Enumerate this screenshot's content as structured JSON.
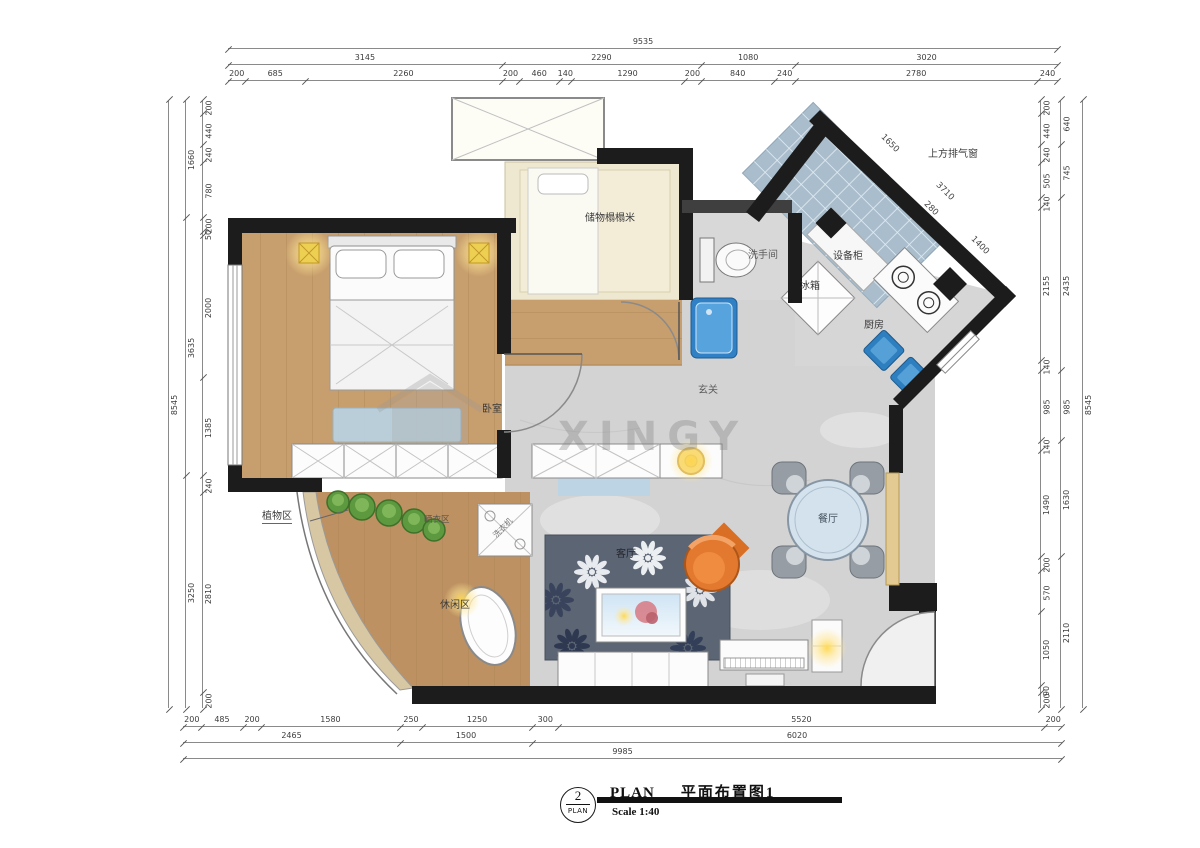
{
  "title_block": {
    "number": "2",
    "number_sub": "PLAN",
    "name_en": "PLAN",
    "name_zh": "平面布置图1",
    "scale": "Scale 1:40"
  },
  "watermark": {
    "text": "XINGY"
  },
  "rooms": {
    "bedroom": "卧室",
    "tatami_storage": "储物榻榻米",
    "bathroom": "洗手间",
    "kitchen": "厨房",
    "fridge": "冰箱",
    "equipment_cabinet": "设备柜",
    "entry": "玄关",
    "dining": "餐厅",
    "living": "客厅",
    "plant_area": "植物区",
    "laundry_area": "晒衣区",
    "leisure_area": "休闲区",
    "washing_machine": "洗衣机",
    "exhaust_window": "上方排气窗"
  },
  "dimensions": {
    "top": [
      [
        9535
      ],
      [
        3145,
        2290,
        1080,
        3020
      ],
      [
        200,
        685,
        2260,
        200,
        460,
        140,
        1290,
        200,
        840,
        240,
        2780,
        240
      ]
    ],
    "bottom": [
      [
        200,
        485,
        200,
        1580,
        250,
        1250,
        300,
        5520,
        200
      ],
      [
        2465,
        1500,
        6020
      ],
      [
        9985
      ]
    ],
    "left": [
      [
        8545
      ],
      [
        1660,
        3635,
        3250
      ],
      [
        200,
        440,
        240,
        780,
        200,
        50,
        2000,
        1385,
        240,
        2810,
        200
      ]
    ],
    "right": [
      [
        200,
        440,
        240,
        505,
        140,
        2155,
        140,
        985,
        140,
        1490,
        200,
        570,
        1050,
        90,
        200
      ],
      [
        640,
        745,
        2435,
        985,
        1630,
        2110
      ],
      [
        8545
      ]
    ],
    "diagonal": [
      "1650",
      "3710",
      "280",
      "1400"
    ]
  }
}
